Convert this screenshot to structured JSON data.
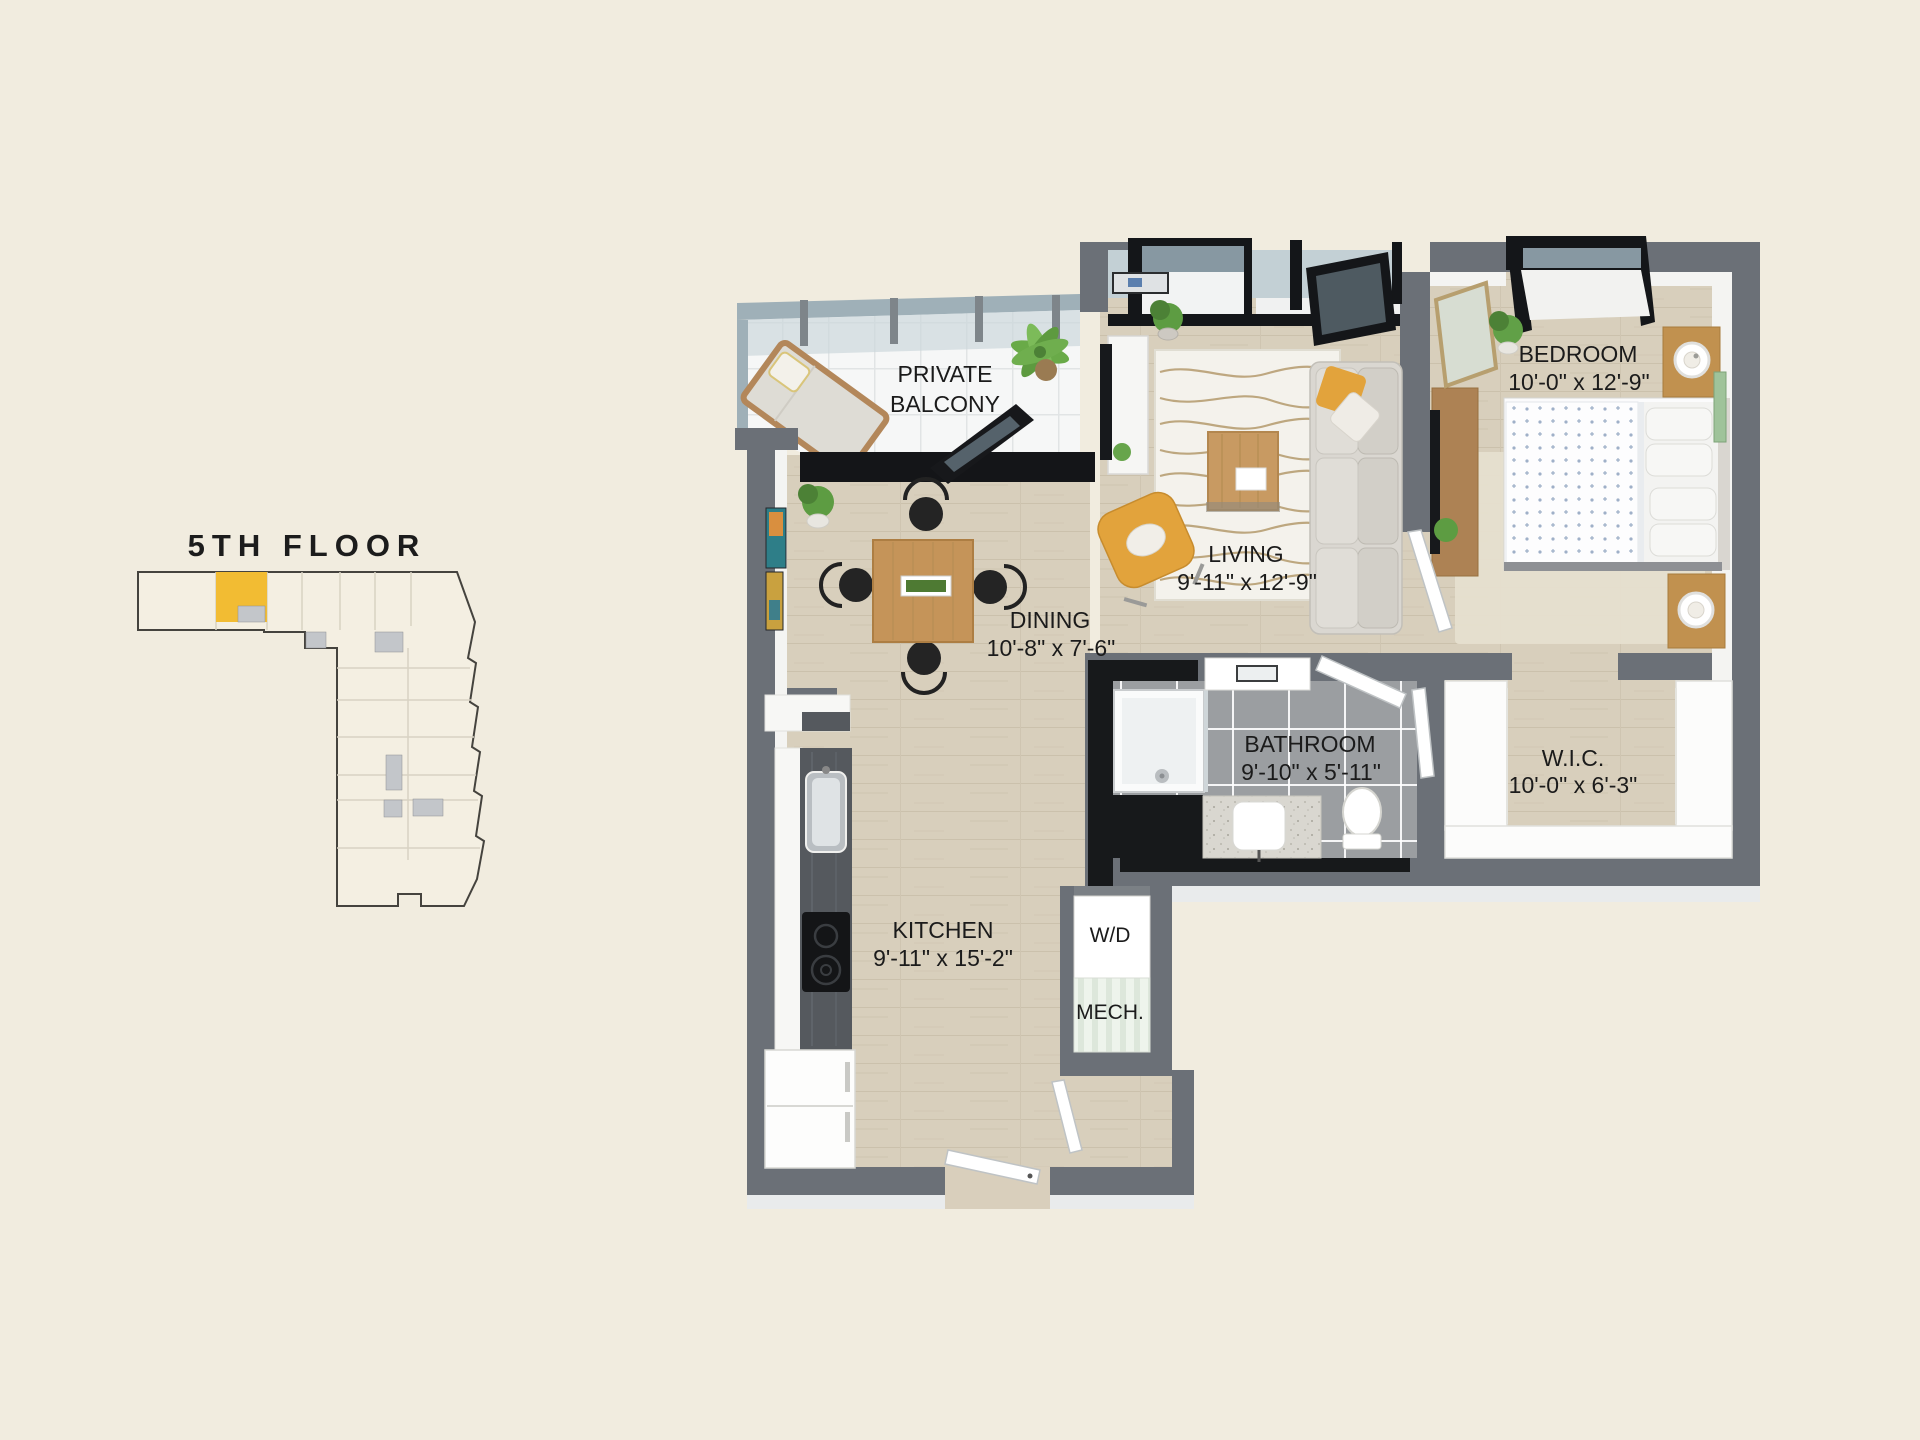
{
  "page": {
    "background": "#f1ecdf"
  },
  "keyplan": {
    "title": "5TH FLOOR",
    "highlight_color": "#f2bc33",
    "core_color": "#c3c6ca"
  },
  "floorplan": {
    "wall_color": "#6b7077",
    "accent_color": "#e2a33c",
    "wood_color": "#d8cfbc",
    "rooms": {
      "balcony": {
        "line1": "PRIVATE",
        "line2": "BALCONY"
      },
      "living": {
        "label": "LIVING",
        "dims": "9'-11\" x 12'-9\""
      },
      "bedroom": {
        "label": "BEDROOM",
        "dims": "10'-0\" x 12'-9\""
      },
      "dining": {
        "label": "DINING",
        "dims": "10'-8\" x 7'-6\""
      },
      "bathroom": {
        "label": "BATHROOM",
        "dims": "9'-10\" x 5'-11\""
      },
      "wic": {
        "label": "W.I.C.",
        "dims": "10'-0\" x 6'-3\""
      },
      "kitchen": {
        "label": "KITCHEN",
        "dims": "9'-11\" x 15'-2\""
      },
      "laundry": {
        "label": "W/D"
      },
      "mech": {
        "label": "MECH."
      }
    }
  }
}
